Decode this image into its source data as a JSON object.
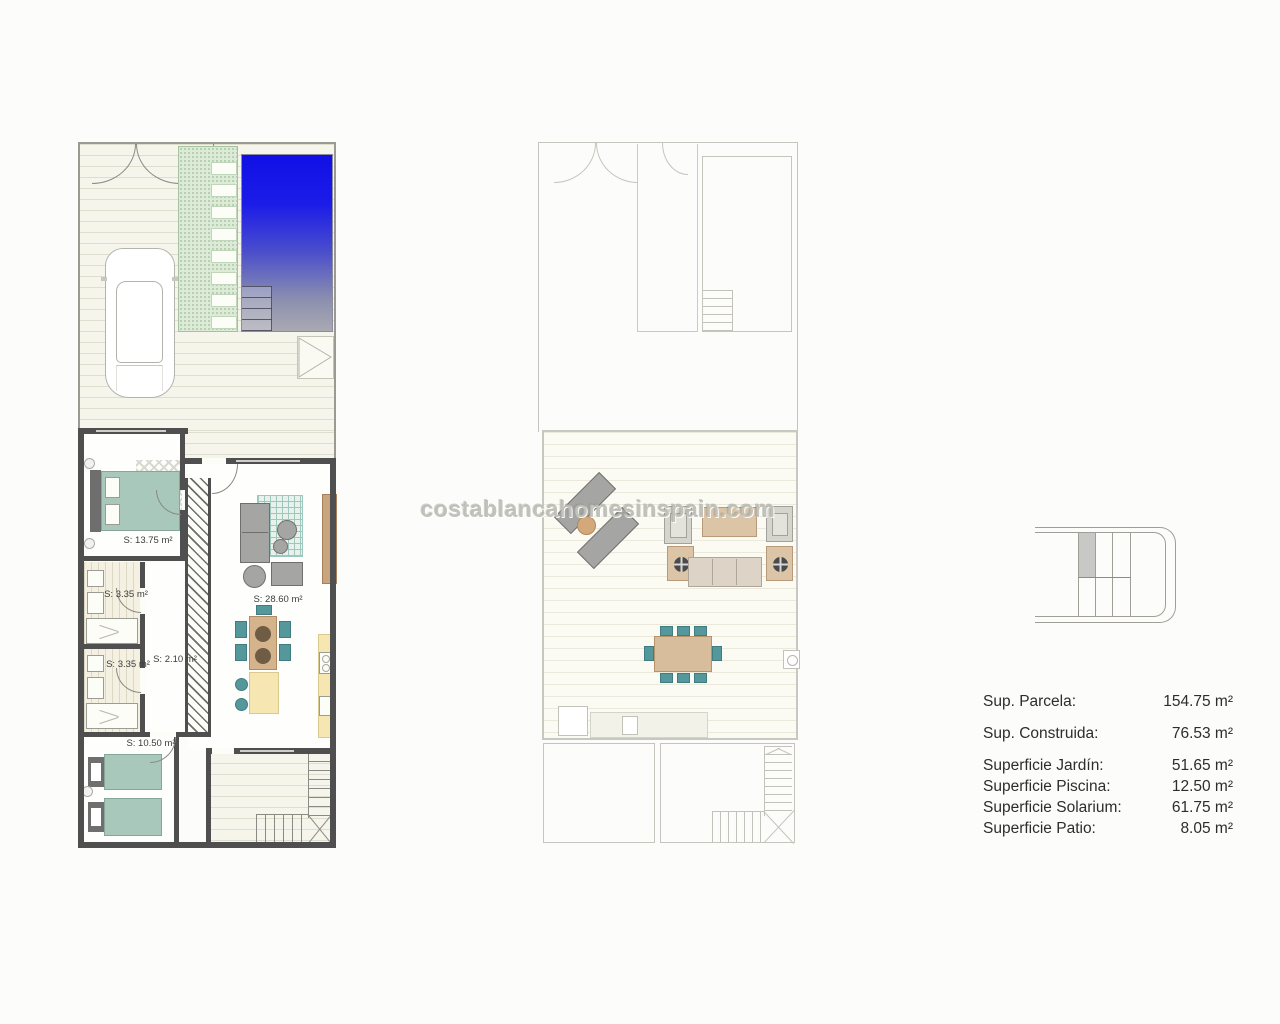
{
  "watermark": "costablancahomesinspain.com",
  "ground_floor": {
    "name": "ground-floor-plan",
    "rooms": [
      {
        "id": "bedroom-1",
        "label": "S: 13.75 m²"
      },
      {
        "id": "bathroom-1",
        "label": "S: 3.35 m²"
      },
      {
        "id": "bathroom-2",
        "label": "S: 3.35 m²"
      },
      {
        "id": "hall",
        "label": "S: 2.10 m²"
      },
      {
        "id": "living-kitchen",
        "label": "S: 28.60 m²"
      },
      {
        "id": "bedroom-2",
        "label": "S: 10.50 m²"
      }
    ]
  },
  "areas_table": {
    "rows": [
      {
        "label": "Sup. Parcela:",
        "value": "154.75 m²"
      },
      {
        "label": "Sup. Construida:",
        "value": "76.53 m²"
      },
      {
        "label": "Superficie Jardín:",
        "value": "51.65 m²"
      },
      {
        "label": "Superficie Piscina:",
        "value": "12.50 m²"
      },
      {
        "label": "Superficie Solarium:",
        "value": "61.75 m²"
      },
      {
        "label": "Superficie Patio:",
        "value": "8.05 m²"
      }
    ]
  },
  "colors": {
    "pool_top": "#1010e6",
    "pool_bottom": "#a9a9b2",
    "accent_teal": "#55989b",
    "bed_teal": "#a7c8ba",
    "wood_tan": "#d5b38d",
    "kitchen_yellow": "#f6e6b2",
    "wall_dark": "#4f4f4f",
    "outline_light": "#c6c5bd"
  }
}
